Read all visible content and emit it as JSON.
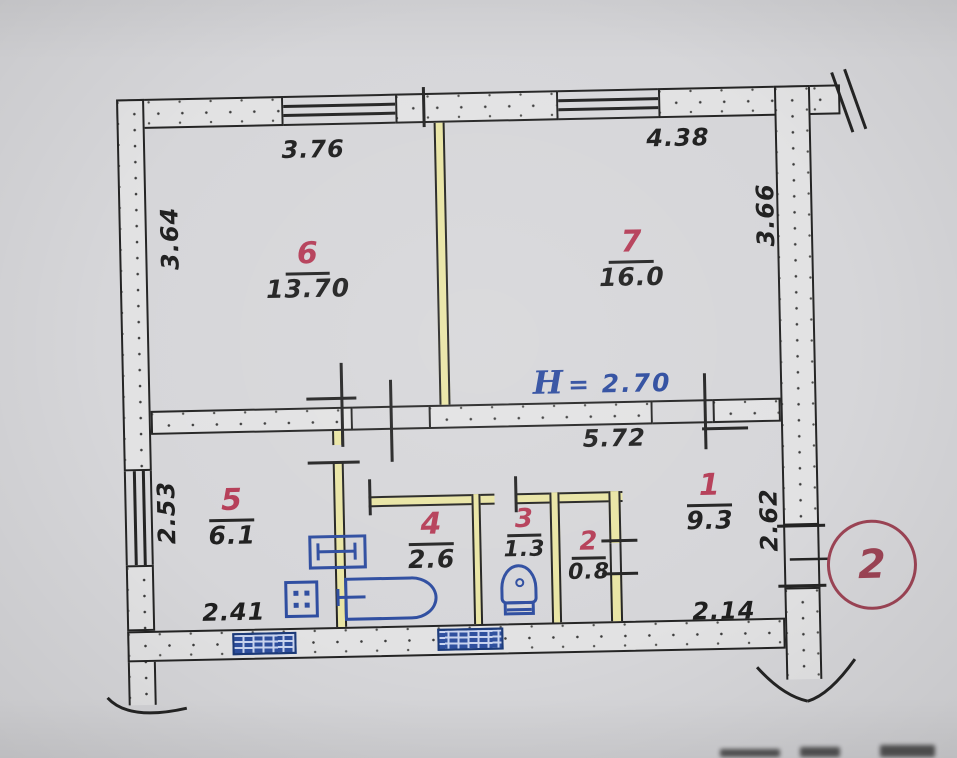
{
  "plan": {
    "rooms": [
      {
        "number": "6",
        "area": "13.70"
      },
      {
        "number": "7",
        "area": "16.0"
      },
      {
        "number": "5",
        "area": "6.1"
      },
      {
        "number": "4",
        "area": "2.6"
      },
      {
        "number": "3",
        "area": "1.3"
      },
      {
        "number": "2",
        "area": "0.8"
      },
      {
        "number": "1",
        "area": "9.3"
      }
    ],
    "dimensions": {
      "top_left": "3.76",
      "top_right": "4.38",
      "left_upper": "3.64",
      "right_upper": "3.66",
      "left_lower": "2.53",
      "bottom_left": "2.41",
      "middle": "5.72",
      "right_lower": "2.62",
      "bottom_right": "2.14"
    },
    "ceiling_height": {
      "symbol": "H",
      "value": "= 2.70"
    },
    "entrance_marker": "2",
    "colors": {
      "paper": "#d6d6d9",
      "ink": "#242424",
      "room_number_red": "#b53d57",
      "fixture_blue": "#2e4da0",
      "partition_yellow": "#e9e5a4",
      "entrance_maroon": "#9c4455",
      "height_note_blue": "#2b4a9e"
    }
  }
}
